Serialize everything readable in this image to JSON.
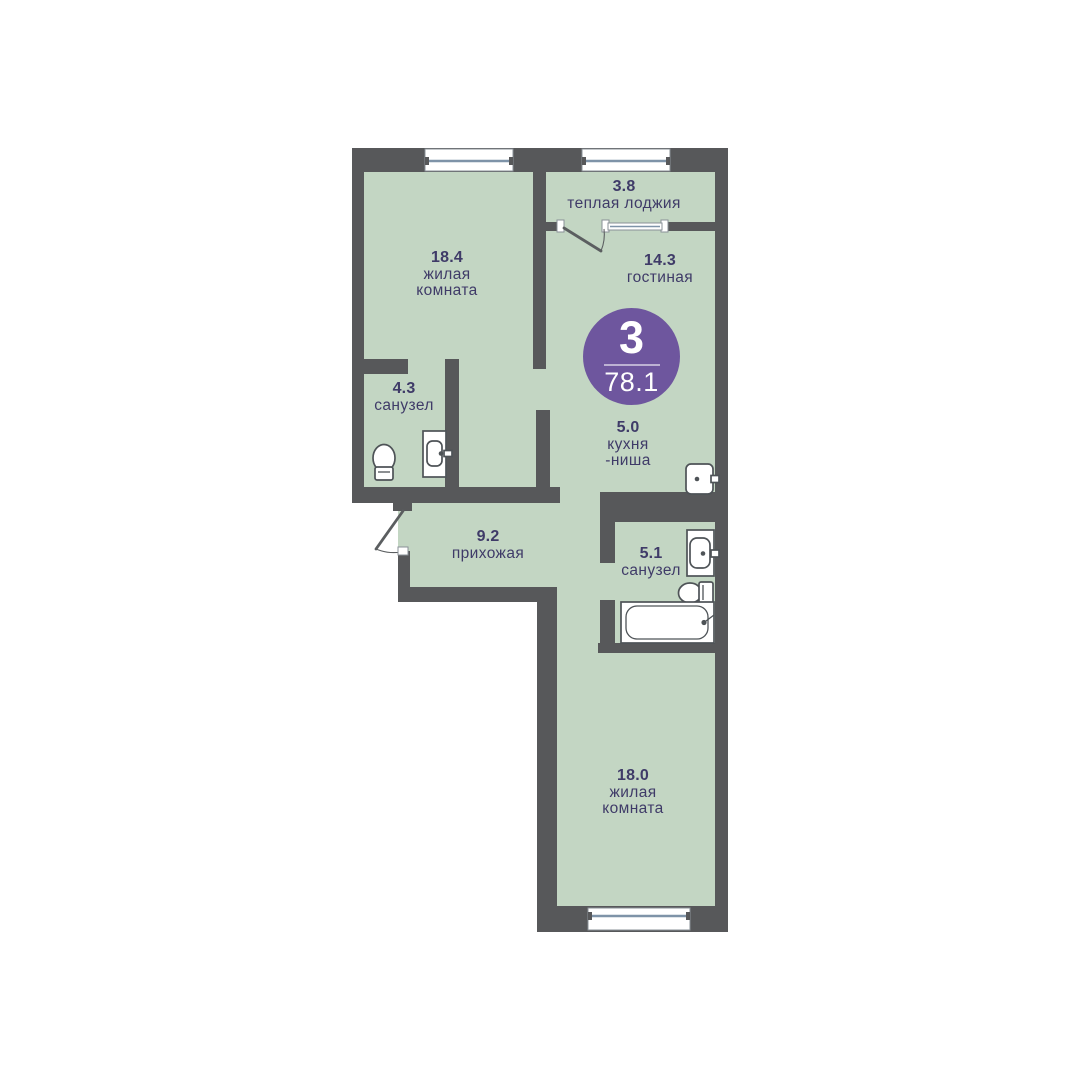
{
  "plan": {
    "type": "apartment-floor-plan",
    "badge": {
      "rooms": "3",
      "area": "78.1"
    },
    "rooms": [
      {
        "num": "3.8",
        "lines": [
          "теплая лоджия"
        ]
      },
      {
        "num": "18.4",
        "lines": [
          "жилая",
          "комната"
        ]
      },
      {
        "num": "14.3",
        "lines": [
          "гостиная"
        ]
      },
      {
        "num": "5.0",
        "lines": [
          "кухня",
          "-ниша"
        ]
      },
      {
        "num": "4.3",
        "lines": [
          "санузел"
        ]
      },
      {
        "num": "9.2",
        "lines": [
          "прихожая"
        ]
      },
      {
        "num": "5.1",
        "lines": [
          "санузел"
        ]
      },
      {
        "num": "18.0",
        "lines": [
          "жилая",
          "комната"
        ]
      }
    ],
    "fixtures": [
      {
        "icon": "toilet-icon",
        "room": "санузел 4.3"
      },
      {
        "icon": "sink-icon",
        "room": "санузел 4.3"
      },
      {
        "icon": "sink-icon",
        "room": "кухня-ниша"
      },
      {
        "icon": "sink-icon",
        "room": "санузел 5.1"
      },
      {
        "icon": "toilet-icon",
        "room": "санузел 5.1"
      },
      {
        "icon": "bathtub-icon",
        "room": "санузел 5.1"
      },
      {
        "icon": "window-icon",
        "count": 3
      },
      {
        "icon": "door-swing-icon",
        "count": 2
      }
    ]
  },
  "colors": {
    "wall": "#57585a",
    "room_fill": "#c3d6c3",
    "label_text": "#3f3b68",
    "badge_bg": "#6e569e",
    "badge_text": "#ffffff",
    "fixture_stroke": "#4e5357",
    "window_glass": "#7e93a8",
    "background": "#ffffff"
  }
}
